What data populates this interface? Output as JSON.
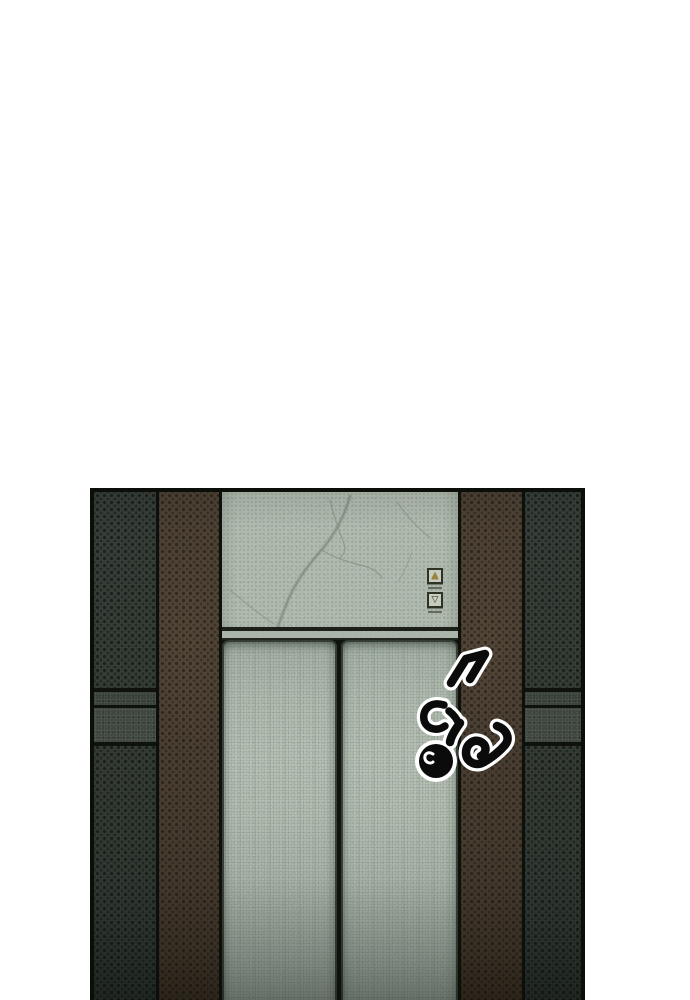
{
  "page": {
    "background_color": "#ffffff"
  },
  "panel": {
    "scene": "Webtoon panel: closed elevator doors framed by brown pillars and dark speckled walls",
    "sfx": {
      "text": "ติ๊ง"
    },
    "elevator": {
      "call_buttons": {
        "up_symbol": "▲",
        "down_symbol": "▽"
      }
    },
    "colors": {
      "outline": "#0c0e0a",
      "wall_dark": "#3a423c",
      "wall_brown": "#55483a",
      "door_marble": "#ccd7ca",
      "door_bright": "#d4dfd2",
      "button_gold": "#b5983a",
      "sfx_fill": "#0b0b0b",
      "sfx_outline": "#ffffff"
    }
  }
}
